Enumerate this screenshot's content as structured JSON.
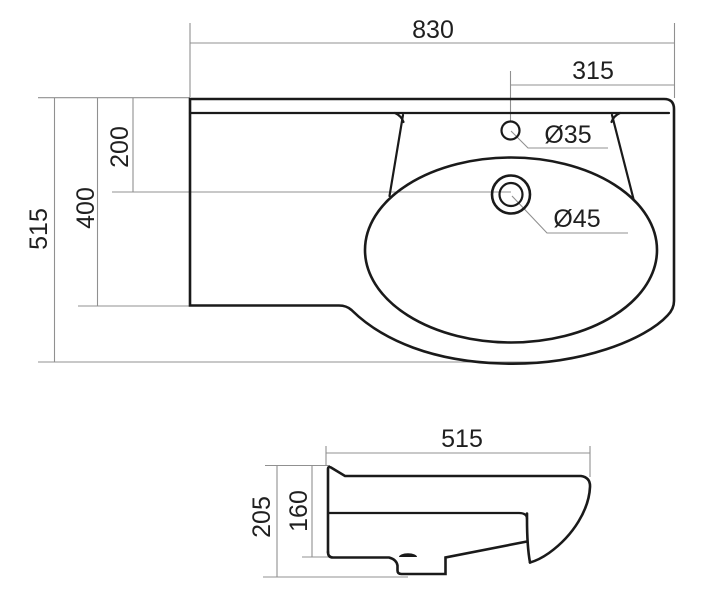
{
  "colors": {
    "background": "#ffffff",
    "outline": "#1a1a1a",
    "dimension_lines": "#909090",
    "label_text": "#1f1f1f"
  },
  "top_view": {
    "dimensions": {
      "overall_width": "830",
      "right_to_faucet": "315",
      "overall_depth": "515",
      "left_edge_depth": "400",
      "back_to_drain": "200",
      "faucet_hole": "Ø35",
      "drain_hole": "Ø45"
    }
  },
  "side_view": {
    "dimensions": {
      "depth": "515",
      "overall_height": "205",
      "body_height": "160"
    }
  }
}
